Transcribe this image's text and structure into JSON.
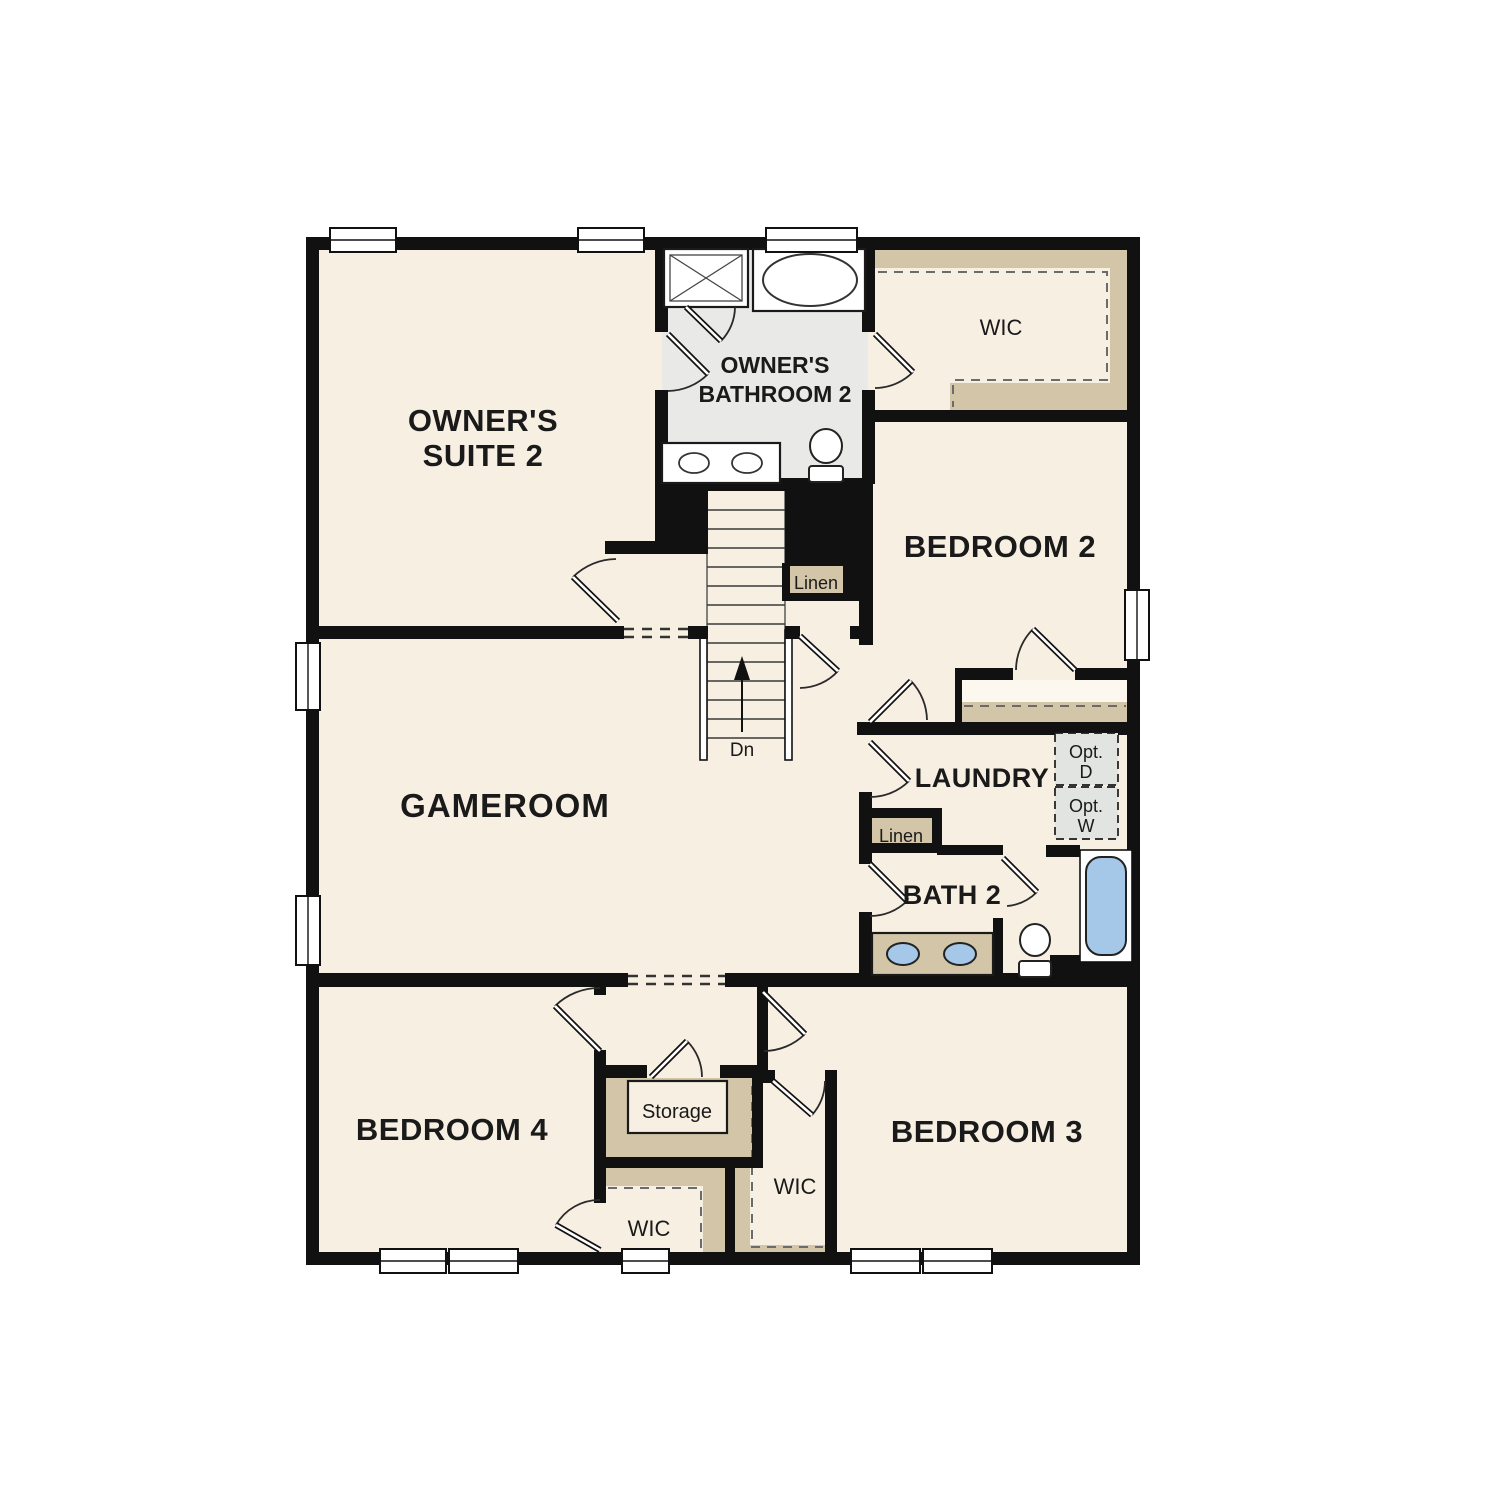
{
  "colors": {
    "floor": "#f7efe2",
    "bathroom_floor": "#e9eae7",
    "shelving_tan": "#d3c5a8",
    "option_box_gray": "#e2e4e1",
    "fixture_blue": "#a5c7e8",
    "wall_black": "#111111"
  },
  "rooms": {
    "owners_suite": {
      "label_line1": "OWNER'S",
      "label_line2": "SUITE 2"
    },
    "owners_bathroom": {
      "label_line1": "OWNER'S",
      "label_line2": "BATHROOM 2"
    },
    "owner_wic": {
      "label": "WIC"
    },
    "bedroom2": {
      "label": "BEDROOM 2"
    },
    "gameroom": {
      "label": "GAMEROOM"
    },
    "laundry": {
      "label": "LAUNDRY"
    },
    "bath2": {
      "label": "BATH 2"
    },
    "bedroom3": {
      "label": "BEDROOM 3"
    },
    "bedroom4": {
      "label": "BEDROOM 4"
    },
    "storage": {
      "label": "Storage"
    },
    "bedroom3_wic": {
      "label": "WIC"
    },
    "bedroom4_wic": {
      "label": "WIC"
    }
  },
  "closets": {
    "linen_upper": {
      "label": "Linen"
    },
    "linen_lower": {
      "label": "Linen"
    }
  },
  "options": {
    "dryer": {
      "label_line1": "Opt.",
      "label_line2": "D"
    },
    "washer": {
      "label_line1": "Opt.",
      "label_line2": "W"
    }
  },
  "stairs": {
    "down_label": "Dn"
  }
}
